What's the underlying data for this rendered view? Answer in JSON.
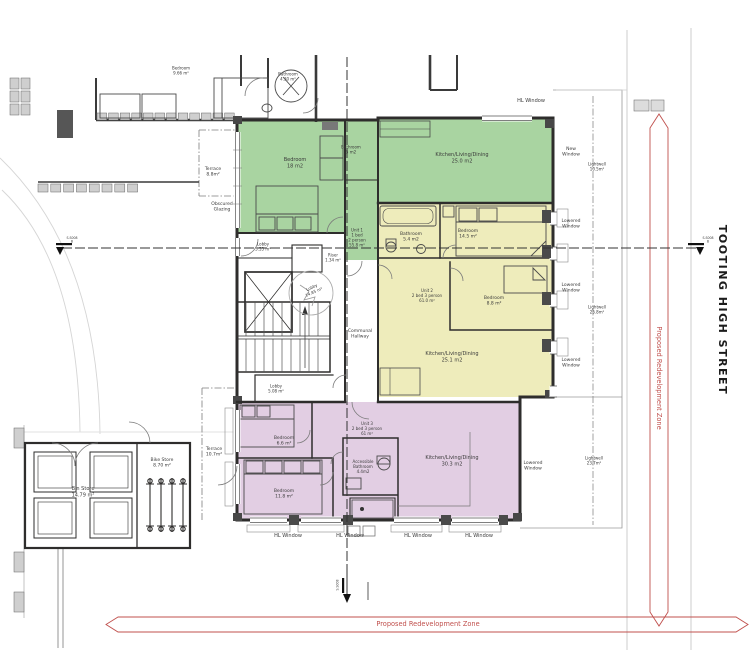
{
  "plan": {
    "street_label": "TOOTING HIGH STREET",
    "zone_label": "Proposed Redevelopment Zone",
    "section_ref": "S.S008",
    "section_letter": "B"
  },
  "colors": {
    "unit1_green": "#a9d4a1",
    "unit2_yellow": "#eeecbb",
    "unit3_purple": "#e2cee3",
    "annotation_red": "#c0504d",
    "wall_dark": "#2e2d2c"
  },
  "units": {
    "unit1": {
      "name": "Unit 1",
      "line2": "1 bed",
      "line3": "2 person",
      "area": "55.8 m²"
    },
    "unit2": {
      "name": "Unit 2",
      "line2": "2 bed 3 person",
      "area": "61.0 m²"
    },
    "unit3": {
      "name": "Unit 3",
      "line2": "2 bed 3 person",
      "area": "61 m²"
    }
  },
  "rooms": {
    "u1_bedroom": {
      "name": "Bedroom",
      "area": "18 m2"
    },
    "u1_bathroom": {
      "name": "Bathroom",
      "area": "5 m2"
    },
    "u1_kitchen": {
      "name": "Kitchen/Living/Dining",
      "area": "25.0 m2"
    },
    "u2_bathroom": {
      "name": "Bathroom",
      "area": "5.4 m2"
    },
    "u2_bedroom_1": {
      "name": "Bedroom",
      "area": "14.5 m²"
    },
    "u2_bedroom_2": {
      "name": "Bedroom",
      "area": "8.8 m²"
    },
    "u2_kitchen": {
      "name": "Kitchen/Living/Dining",
      "area": "25.1 m2"
    },
    "u3_bedroom_1": {
      "name": "Bedroom",
      "area": "6.6 m²"
    },
    "u3_bedroom_2": {
      "name": "Bedroom",
      "area": "11.8 m²"
    },
    "u3_bathroom": {
      "line1": "Accessible",
      "line2": "Bathroom",
      "area": "4.4m2"
    },
    "u3_kitchen": {
      "name": "Kitchen/Living/Dining",
      "area": "30.3 m2"
    }
  },
  "common": {
    "lobby_entrance": {
      "name": "Lobby",
      "area": "3.55 m²"
    },
    "riser": {
      "name": "Riser",
      "area": "1.34 m²"
    },
    "lobby_lift": {
      "name": "Lobby",
      "area": "14.85 m²"
    },
    "lobby_lower": {
      "name": "Lobby",
      "area": "5.08 m²"
    },
    "communal_hallway": {
      "line1": "Communal",
      "line2": "Hallway"
    },
    "bin_store": {
      "name": "Bin Store",
      "area": "14.79 m²"
    },
    "bike_store": {
      "name": "Bike Store",
      "area": "8.70 m²"
    },
    "terrace_upper": {
      "name": "Terrace",
      "area": "8.8m²"
    },
    "terrace_lower": {
      "name": "Terrace",
      "area": "10.7m²"
    },
    "obscured_glazing": {
      "line1": "Obscured",
      "line2": "Glazing"
    }
  },
  "neighbour": {
    "bedroom": {
      "name": "Bedroom",
      "area": "9.66 m²"
    },
    "bathroom": {
      "name": "Bathroom",
      "area": "4.30 m²"
    }
  },
  "windows": {
    "hl_window": "HL Window",
    "new_window": {
      "line1": "New",
      "line2": "Window"
    },
    "lowered_window": {
      "line1": "Lowered",
      "line2": "Window"
    },
    "lightwell_1": {
      "name": "Lightwell",
      "area": "10.5m²"
    },
    "lightwell_2": {
      "name": "Lightwell",
      "area": "25.8m²"
    },
    "lightwell_3": {
      "name": "Lightwell",
      "area": "23.7m²"
    }
  }
}
